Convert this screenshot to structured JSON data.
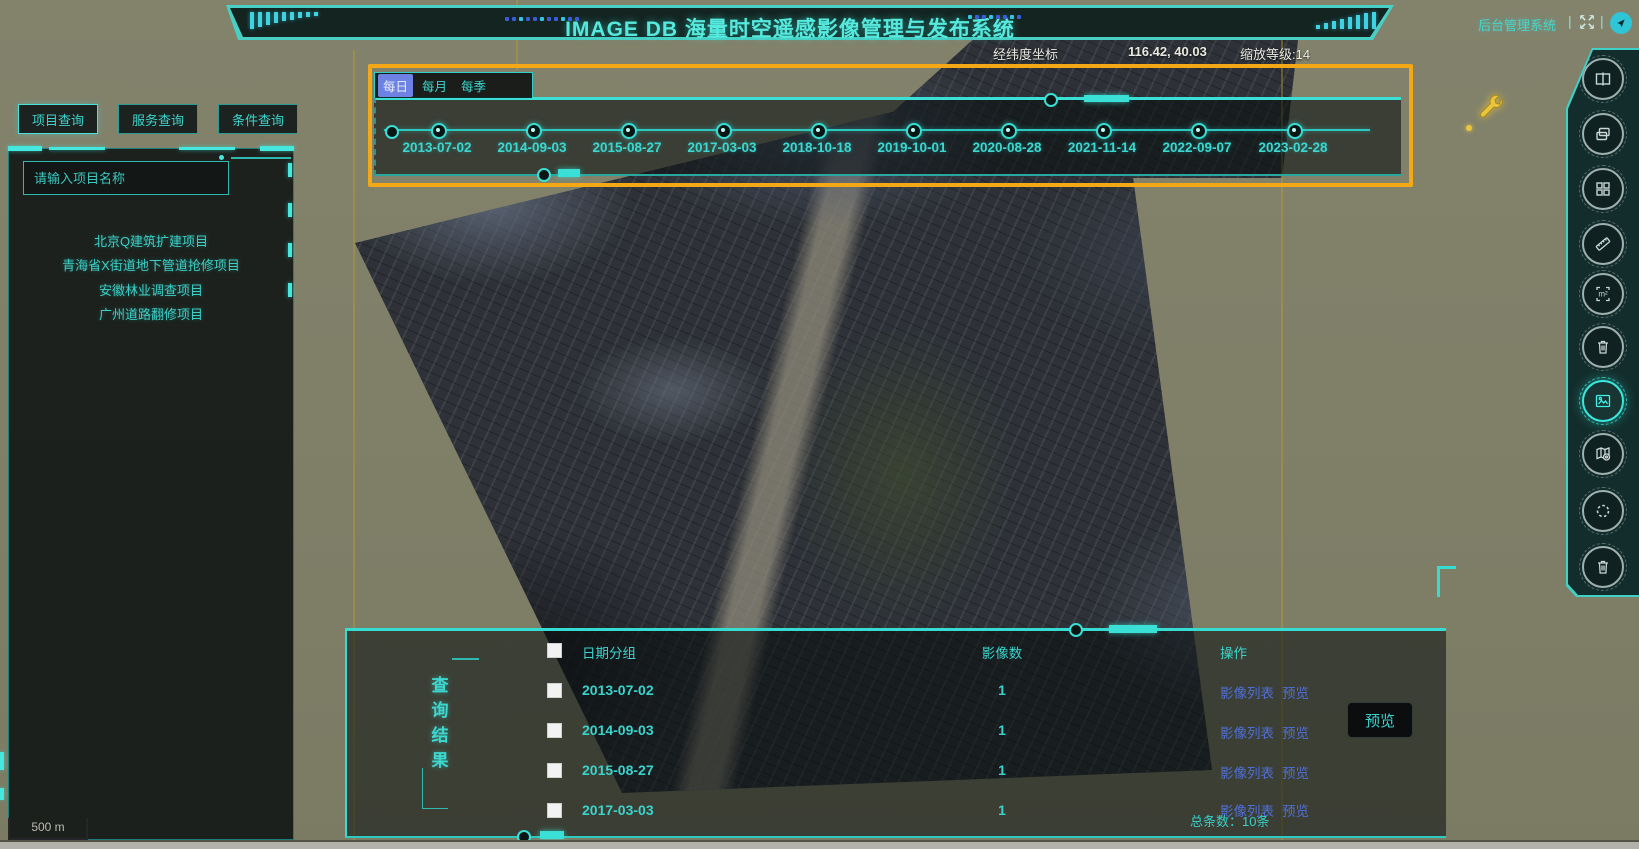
{
  "app": {
    "title": "IMAGE DB 海量时空遥感影像管理与发布系统",
    "admin_link": "后台管理系统",
    "status": {
      "coords_label": "经纬度坐标",
      "coords_value": "116.42, 40.03",
      "zoom_level": "缩放等级:14"
    },
    "accent_color": "#35dcd2",
    "highlight_color": "#f5a816",
    "link_color": "#4f6fd8",
    "active_tab_color": "#6d82e2"
  },
  "left_panel": {
    "tabs": [
      {
        "label": "项目查询"
      },
      {
        "label": "服务查询"
      },
      {
        "label": "条件查询"
      }
    ],
    "search": {
      "placeholder": "请输入项目名称"
    },
    "projects": [
      {
        "name": "北京Q建筑扩建项目"
      },
      {
        "name": "青海省X街道地下管道抢修项目"
      },
      {
        "name": "安徽林业调查项目"
      },
      {
        "name": "广州道路翻修项目"
      }
    ]
  },
  "timeline": {
    "tabs": [
      {
        "label": "每日"
      },
      {
        "label": "每月"
      },
      {
        "label": "每季"
      }
    ],
    "active_tab": "每日",
    "dates": [
      "2013-07-02",
      "2014-09-03",
      "2015-08-27",
      "2017-03-03",
      "2018-10-18",
      "2019-10-01",
      "2020-08-28",
      "2021-11-14",
      "2022-09-07",
      "2023-02-28"
    ]
  },
  "results": {
    "title_vertical": "查询结果",
    "columns": {
      "group": "日期分组",
      "count": "影像数",
      "actions": "操作"
    },
    "rows": [
      {
        "date": "2013-07-02",
        "count": "1",
        "list_link": "影像列表",
        "preview_link": "预览"
      },
      {
        "date": "2014-09-03",
        "count": "1",
        "list_link": "影像列表",
        "preview_link": "预览"
      },
      {
        "date": "2015-08-27",
        "count": "1",
        "list_link": "影像列表",
        "preview_link": "预览"
      },
      {
        "date": "2017-03-03",
        "count": "1",
        "list_link": "影像列表",
        "preview_link": "预览"
      }
    ],
    "total": "总条数：10条",
    "preview_button": "预览"
  },
  "map": {
    "scale_label": "500 m"
  },
  "toolbar": {
    "icons": [
      "swipe-compare",
      "layer-manage",
      "grid-split",
      "measure-distance",
      "measure-area",
      "delete",
      "image-export",
      "map-annotation",
      "refresh-loading",
      "clear-all"
    ]
  }
}
